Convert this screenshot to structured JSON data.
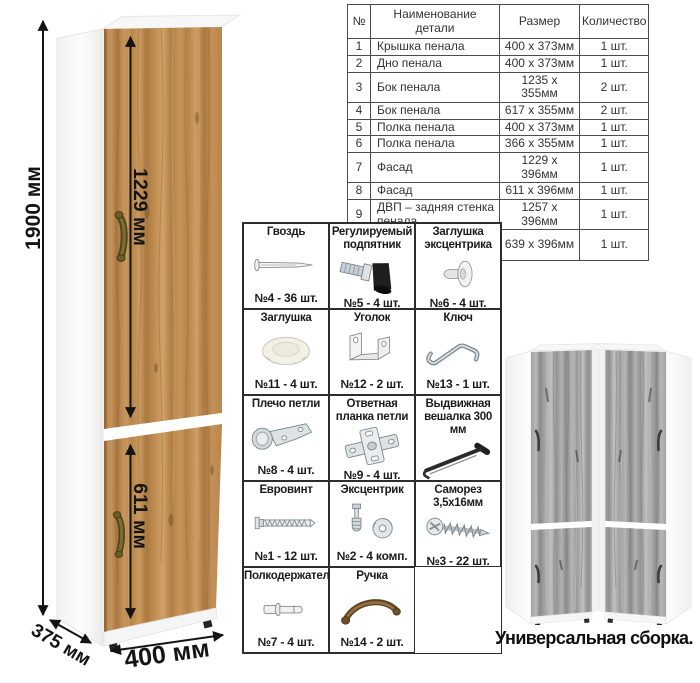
{
  "cabinet": {
    "height": "1900 мм",
    "upper_door": "1229 мм",
    "lower_door": "611 мм",
    "depth": "375 мм",
    "width": "400 мм",
    "wood_color": "#c09055",
    "gray_wood_color": "#9f9f9f",
    "handle_color": "#6e5f27"
  },
  "parts_table": {
    "headers": [
      "№",
      "Наименование детали",
      "Размер",
      "Количество"
    ],
    "rows": [
      [
        "1",
        "Крышка пенала",
        "400 х 373мм",
        "1 шт."
      ],
      [
        "2",
        "Дно пенала",
        "400 х 373мм",
        "1 шт."
      ],
      [
        "3",
        "Бок пенала",
        "1235 х 355мм",
        "2 шт."
      ],
      [
        "4",
        "Бок пенала",
        "617 х 355мм",
        "2 шт."
      ],
      [
        "5",
        "Полка пенала",
        "400 х 373мм",
        "1 шт."
      ],
      [
        "6",
        "Полка пенала",
        "366 х 355мм",
        "1 шт."
      ],
      [
        "7",
        "Фасад",
        "1229 х 396мм",
        "1 шт."
      ],
      [
        "8",
        "Фасад",
        "611 х 396мм",
        "1 шт."
      ],
      [
        "9",
        "ДВП – задняя стенка пенала",
        "1257 х 396мм",
        "1 шт."
      ],
      [
        "10",
        "ДВП – задняя стенка пенала",
        "639 х 396мм",
        "1 шт."
      ]
    ]
  },
  "hardware": [
    {
      "name": "Гвоздь",
      "qty": "№4 - 36 шт.",
      "icon": "nail-icon"
    },
    {
      "name": "Регулируемый подпятник",
      "qty": "№5 - 4 шт.",
      "icon": "adjustable-foot-icon"
    },
    {
      "name": "Заглушка эксцентрика",
      "qty": "№6 - 4 шт.",
      "icon": "cam-cover-icon"
    },
    {
      "name": "Заглушка",
      "qty": "№11 - 4 шт.",
      "icon": "cap-icon"
    },
    {
      "name": "Уголок",
      "qty": "№12 - 2 шт.",
      "icon": "corner-bracket-icon"
    },
    {
      "name": "Ключ",
      "qty": "№13 - 1 шт.",
      "icon": "key-icon"
    },
    {
      "name": "Плечо петли",
      "qty": "№8 - 4 шт.",
      "icon": "hinge-arm-icon"
    },
    {
      "name": "Ответная планка петли",
      "qty": "№9 - 4 шт.",
      "icon": "hinge-plate-icon"
    },
    {
      "name": "Выдвижная вешалка 300 мм",
      "qty": "№10 - 1 шт.",
      "icon": "pullout-hanger-icon"
    },
    {
      "name": "Евровинт",
      "qty": "№1 - 12 шт.",
      "icon": "confirmat-screw-icon"
    },
    {
      "name": "Эксцентрик",
      "qty": "№2 - 4 комп.",
      "icon": "cam-lock-icon"
    },
    {
      "name": "Саморез 3,5х16мм",
      "qty": "№3 - 22 шт.",
      "icon": "screw-icon"
    },
    {
      "name": "Полкодержатель",
      "qty": "№7 - 4 шт.",
      "icon": "shelf-pin-icon"
    },
    {
      "name": "Ручка",
      "qty": "№14 - 2 шт.",
      "icon": "handle-icon"
    }
  ],
  "variants_caption": "Универсальная сборка."
}
